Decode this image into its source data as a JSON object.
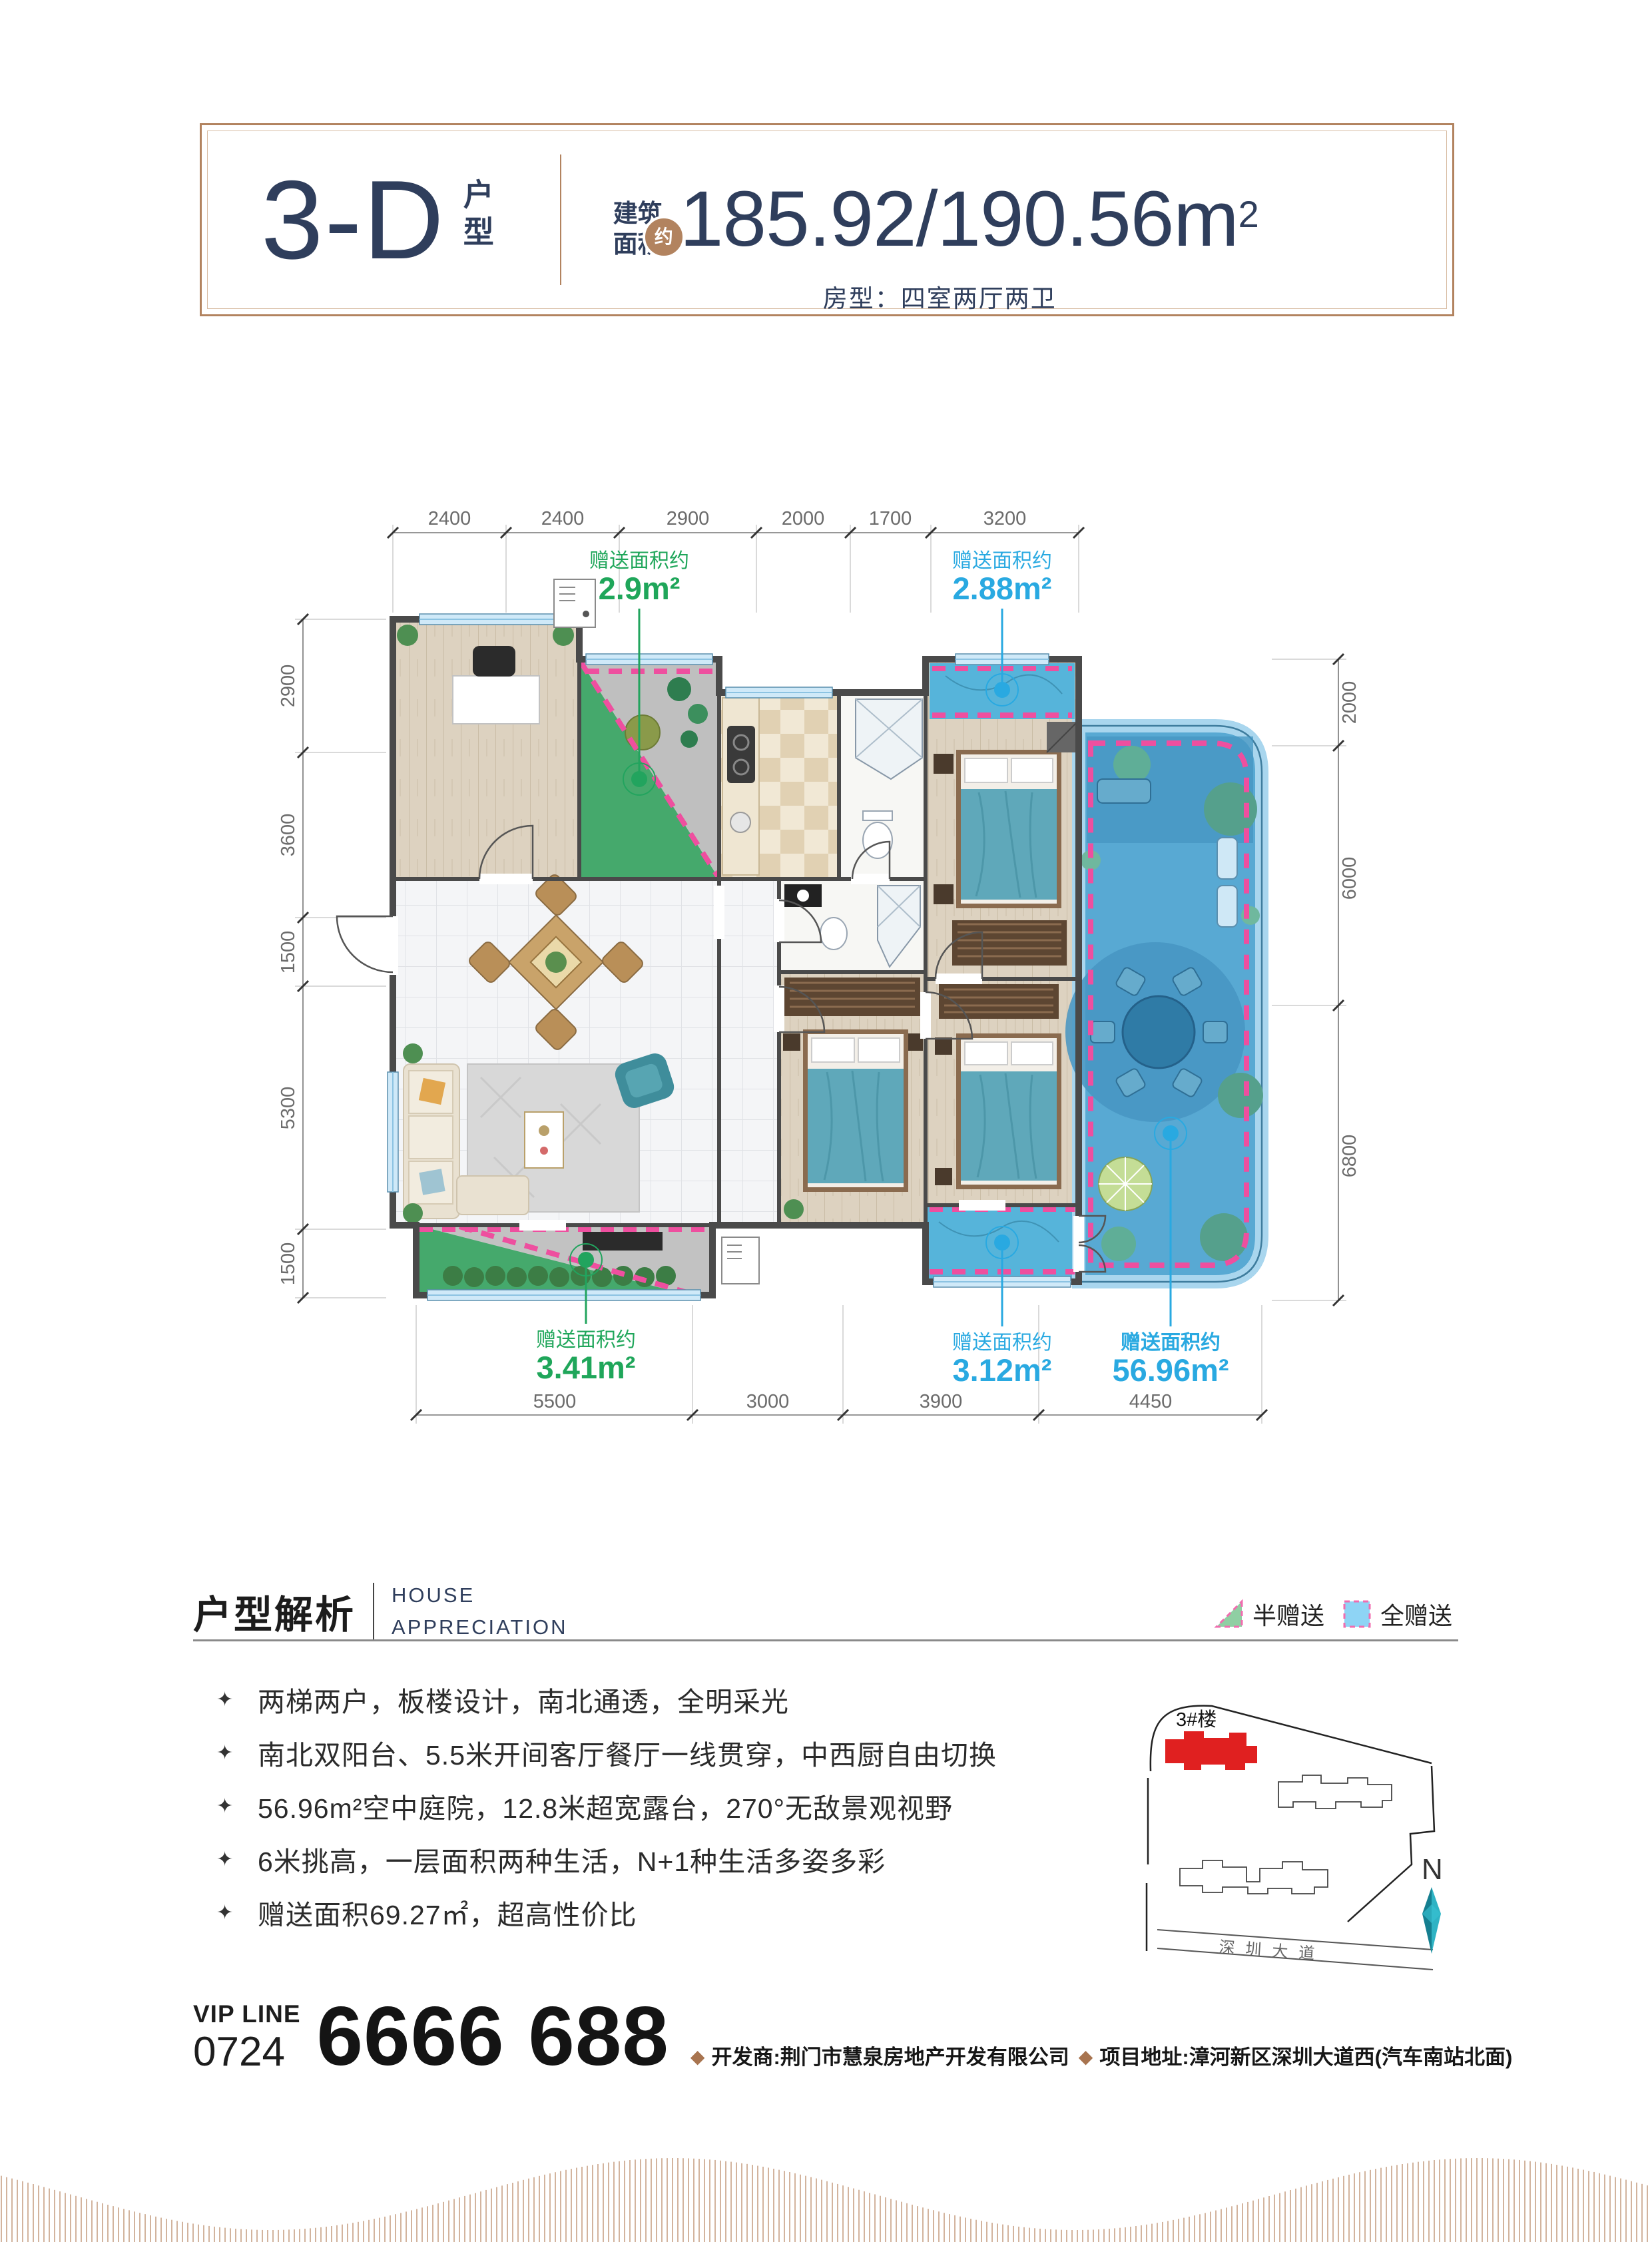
{
  "header": {
    "type_code": "3-D",
    "type_suffix": "户型",
    "area_cn_1": "建筑",
    "area_cn_2": "面积",
    "area_approx": "约",
    "area_value": "185.92/190.56m",
    "area_sup": "2",
    "room_layout": "房型：四室两厅两卫"
  },
  "plan": {
    "dims": {
      "top": [
        "2400",
        "2400",
        "2900",
        "2000",
        "1700",
        "3200"
      ],
      "left": [
        "2900",
        "3600",
        "1500",
        "5300",
        "1500"
      ],
      "right": [
        "2000",
        "6000",
        "6800"
      ],
      "bottom": [
        "5500",
        "3000",
        "3900",
        "4450"
      ]
    },
    "gifts": [
      {
        "label": "赠送面积约",
        "value": "2.9m²",
        "type": "half"
      },
      {
        "label": "赠送面积约",
        "value": "2.88m²",
        "type": "full"
      },
      {
        "label": "赠送面积约",
        "value": "3.41m²",
        "type": "half"
      },
      {
        "label": "赠送面积约",
        "value": "3.12m²",
        "type": "full"
      },
      {
        "label": "赠送面积约",
        "value": "56.96m²",
        "type": "full"
      }
    ]
  },
  "analysis": {
    "title": "户型解析",
    "subtitle_line1": "HOUSE",
    "subtitle_line2": "APPRECIATION",
    "legend": [
      {
        "label": "半赠送",
        "swatch": "green-triangle"
      },
      {
        "label": "全赠送",
        "swatch": "blue-square"
      }
    ],
    "bullets": [
      "两梯两户，板楼设计，南北通透，全明采光",
      "南北双阳台、5.5米开间客厅餐厅一线贯穿，中西厨自由切换",
      "56.96m²空中庭院，12.8米超宽露台，270°无敌景观视野",
      "6米挑高，一层面积两种生活，N+1种生活多姿多彩",
      "赠送面积69.27㎡，超高性价比"
    ]
  },
  "sitemap": {
    "building_label": "3#楼",
    "road": "深圳大道",
    "north": "N"
  },
  "footer": {
    "vip_line": "VIP LINE",
    "vip_code": "0724",
    "phone": "6666 688",
    "developer": "开发商:荆门市慧泉房地产开发有限公司",
    "address": "项目地址:漳河新区深圳大道西(汽车南站北面)"
  },
  "colors": {
    "navy": "#2f3e5c",
    "tan": "#b2835f",
    "gift_green": "#1fa65a",
    "gift_blue": "#29a9e1",
    "pink_dash": "#ee4f9f",
    "building_red": "#e02020",
    "compass_teal": "#26a3b5"
  }
}
